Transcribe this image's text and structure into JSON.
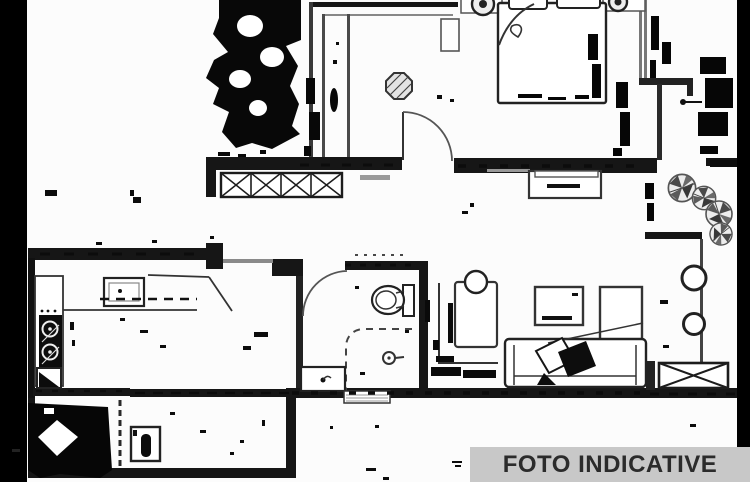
{
  "canvas": {
    "width": 750,
    "height": 482,
    "background": "#fcfcfc",
    "line_color": "#1c1c1c",
    "wall_color": "#161616",
    "mask_band_color": "#000000"
  },
  "label": {
    "text": "FOTO INDICATIVE",
    "bg_color": "#c8c8c8",
    "text_color": "#2b2b2b"
  },
  "floorplan": {
    "kind": "apartment-floor-plan-scan",
    "symbols": [
      {
        "name": "double-bed"
      },
      {
        "name": "pillow"
      },
      {
        "name": "nightstand-lamp"
      },
      {
        "name": "ceiling-light-octagon"
      },
      {
        "name": "wardrobe-dark-mass"
      },
      {
        "name": "window-hatch-strip"
      },
      {
        "name": "radiator-hatch-box"
      },
      {
        "name": "toilet"
      },
      {
        "name": "shower-drain"
      },
      {
        "name": "washbasin"
      },
      {
        "name": "cooktop-hob"
      },
      {
        "name": "kitchen-sink"
      },
      {
        "name": "kitchen-counter"
      },
      {
        "name": "washing-machine"
      },
      {
        "name": "sofa"
      },
      {
        "name": "coffee-table"
      },
      {
        "name": "tv-cabinet"
      },
      {
        "name": "armchair"
      },
      {
        "name": "desk"
      },
      {
        "name": "stool-circle"
      },
      {
        "name": "potted-plant"
      },
      {
        "name": "door-swing-arc"
      },
      {
        "name": "console-table"
      }
    ]
  }
}
